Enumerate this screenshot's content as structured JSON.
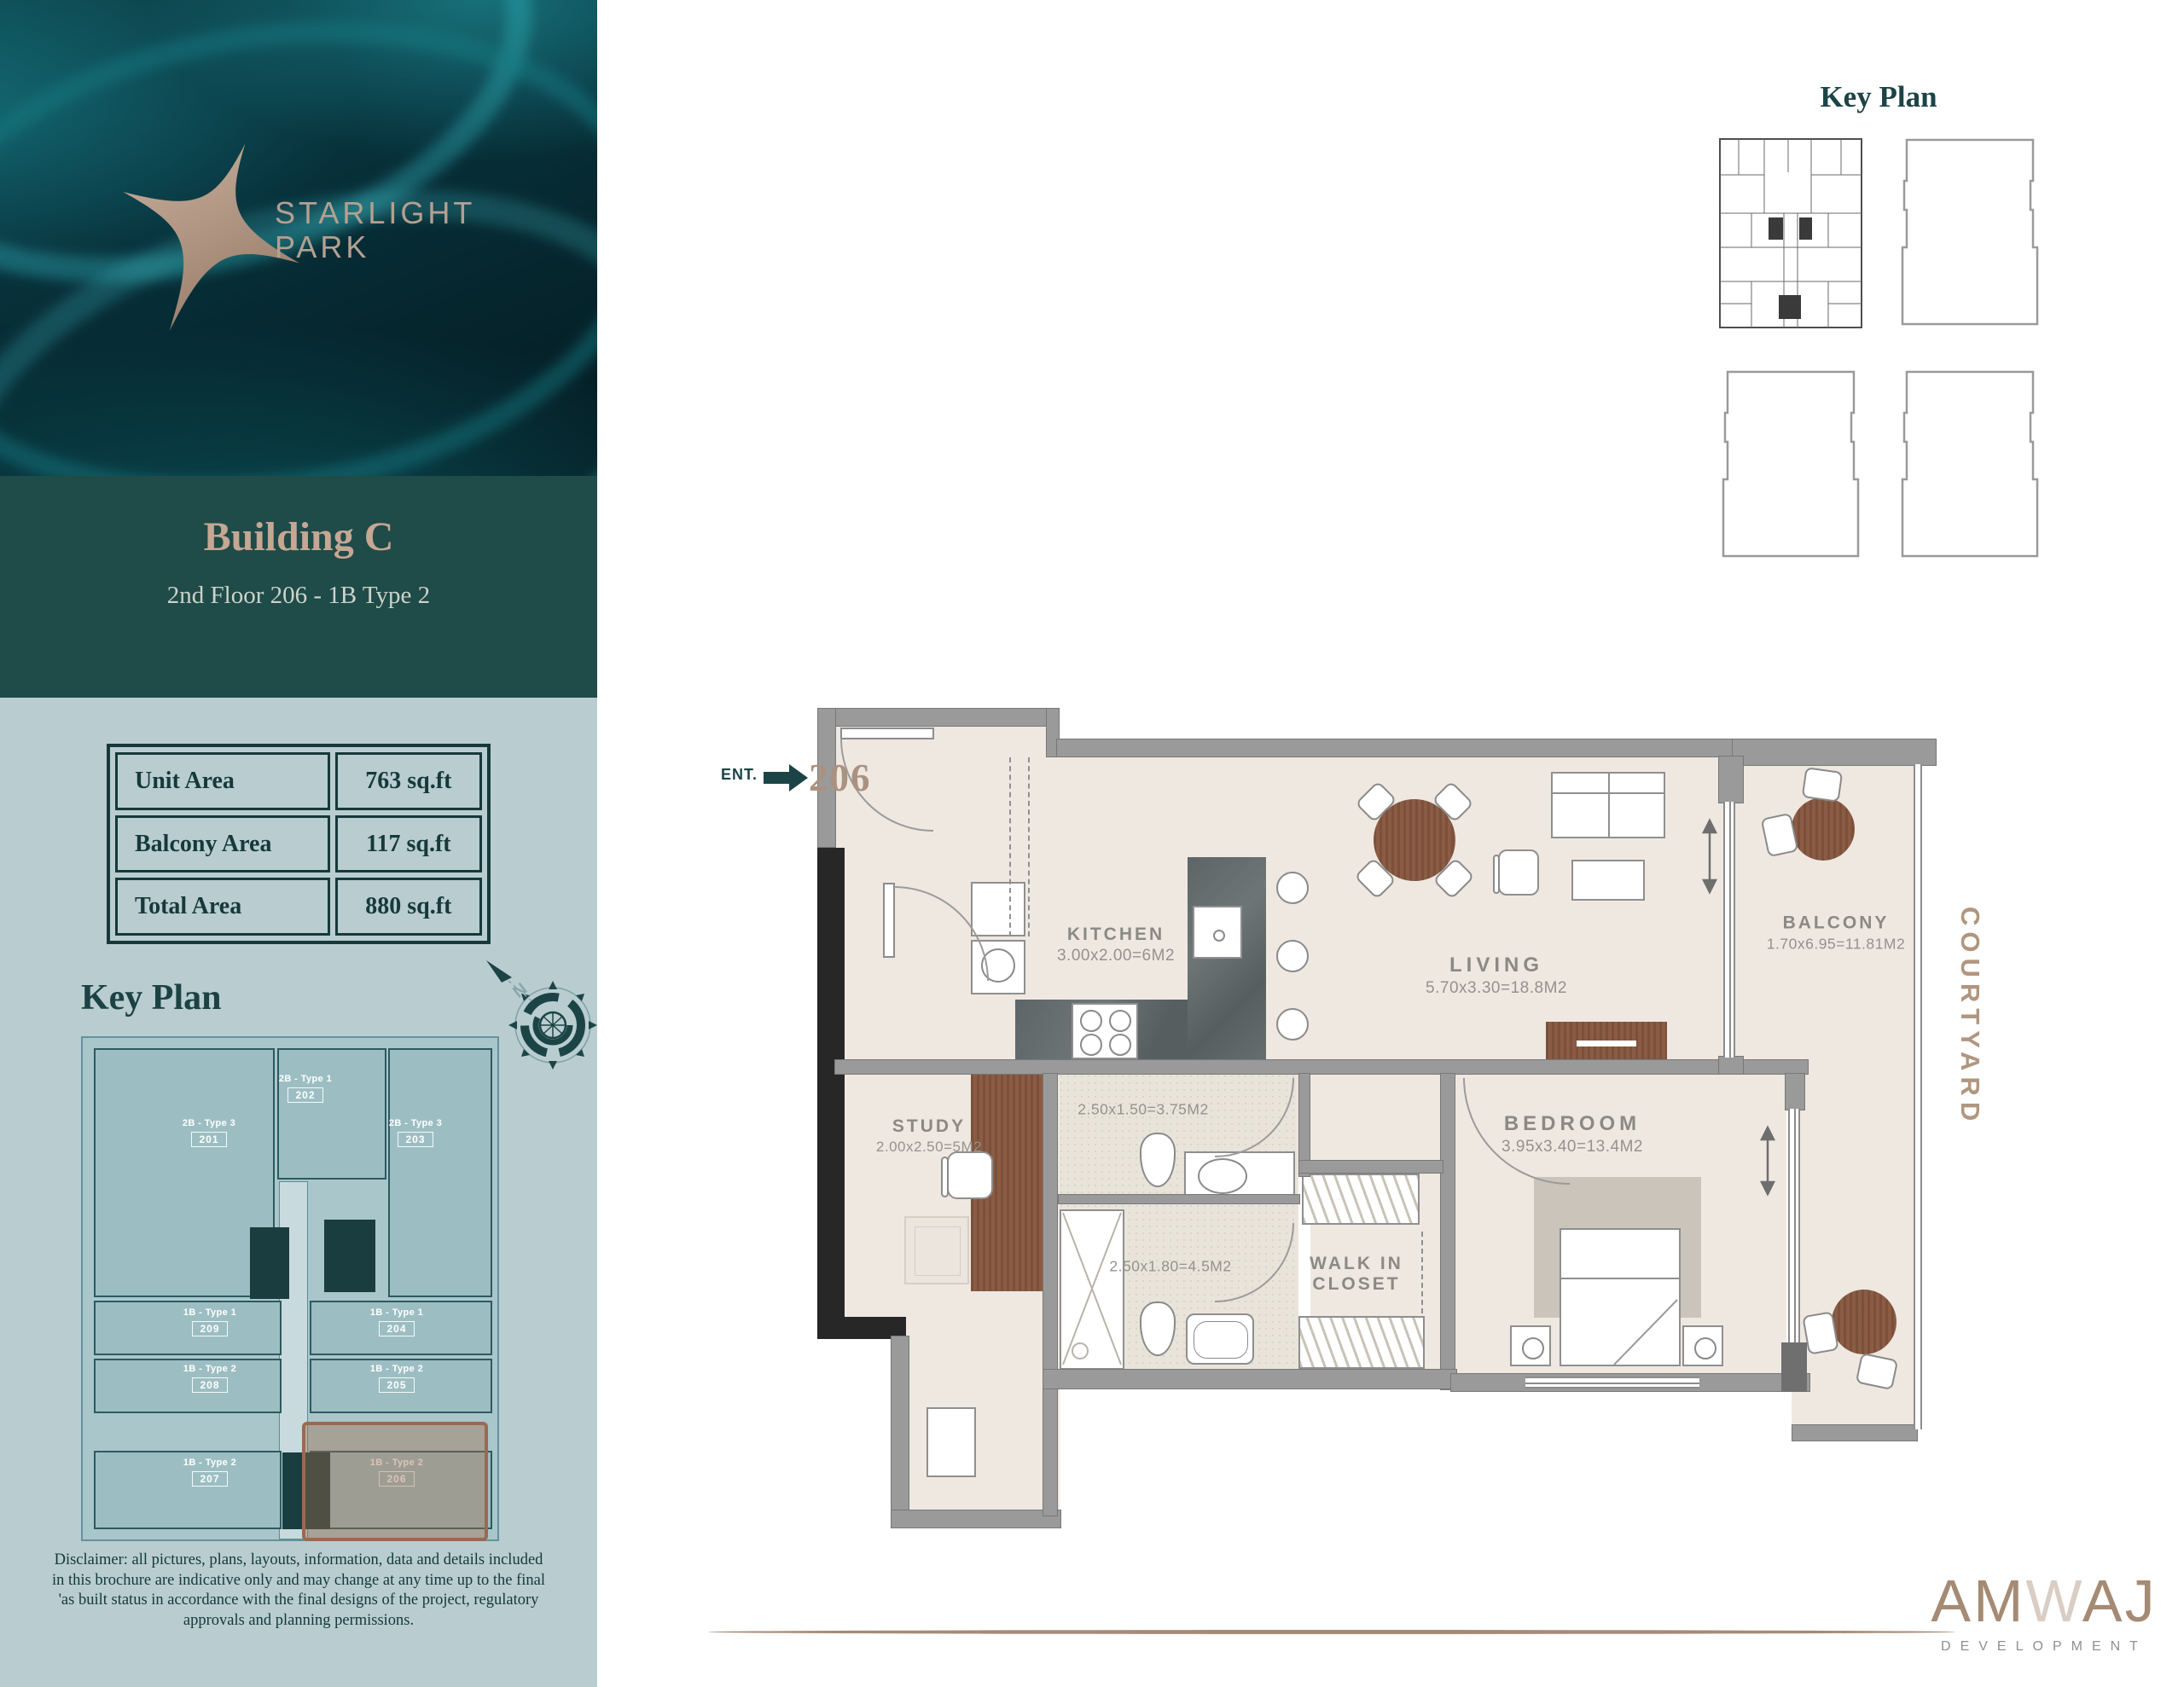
{
  "colors": {
    "accent_teal": "#1c4446",
    "accent_tan": "#b2977f",
    "band_teal": "#1f4b49",
    "sidebar_panel": "#b9cdd1",
    "map_unit_teal": "#9cbec3",
    "highlight_brown": "#9a6a50",
    "wall_gray": "#9a9a9a",
    "wood_brown": "#8a5c44"
  },
  "sidebar": {
    "brand": {
      "line1": "STARLIGHT",
      "line2": "PARK"
    },
    "building_title": "Building C",
    "building_subtitle": "2nd Floor 206 - 1B Type 2",
    "area_table": {
      "rows": [
        {
          "label": "Unit Area",
          "value": "763 sq.ft"
        },
        {
          "label": "Balcony Area",
          "value": "117 sq.ft"
        },
        {
          "label": "Total Area",
          "value": "880 sq.ft"
        }
      ]
    },
    "key_plan_title": "Key Plan",
    "key_plan_units": [
      {
        "type": "2B - Type 3",
        "number": "201"
      },
      {
        "type": "2B - Type 1",
        "number": "202"
      },
      {
        "type": "2B - Type 3",
        "number": "203"
      },
      {
        "type": "1B - Type 1",
        "number": "209"
      },
      {
        "type": "1B - Type 2",
        "number": "208"
      },
      {
        "type": "1B - Type 2",
        "number": "207"
      },
      {
        "type": "1B - Type 1",
        "number": "204"
      },
      {
        "type": "1B - Type 2",
        "number": "205"
      },
      {
        "type": "1B - Type 2",
        "number": "206"
      }
    ],
    "compass_label": "N",
    "disclaimer": "Disclaimer: all pictures, plans, layouts, information, data and details included in this brochure are indicative only and may change at any time up to the final 'as built status in accordance with the final designs of the project, regulatory approvals and planning permissions."
  },
  "main": {
    "key_plan_title": "Key Plan",
    "entrance": {
      "label": "ENT.",
      "unit_number": "206"
    },
    "rooms": {
      "kitchen": {
        "name": "KITCHEN",
        "dims": "3.00x2.00=6M2"
      },
      "living": {
        "name": "LIVING",
        "dims": "5.70x3.30=18.8M2"
      },
      "balcony": {
        "name": "BALCONY",
        "dims": "1.70x6.95=11.81M2"
      },
      "bedroom": {
        "name": "BEDROOM",
        "dims": "3.95x3.40=13.4M2"
      },
      "study": {
        "name": "STUDY",
        "dims": "2.00x2.50=5M2"
      },
      "bath1": {
        "dims": "2.50x1.50=3.75M2"
      },
      "bath2": {
        "dims": "2.50x1.80=4.5M2"
      },
      "walk_in_closet": {
        "line1": "WALK IN",
        "line2": "CLOSET"
      },
      "courtyard": "COURTYARD"
    },
    "logo": {
      "name_part1": "AM",
      "name_part2": "W",
      "name_part3": "AJ",
      "tagline": "DEVELOPMENT"
    }
  }
}
